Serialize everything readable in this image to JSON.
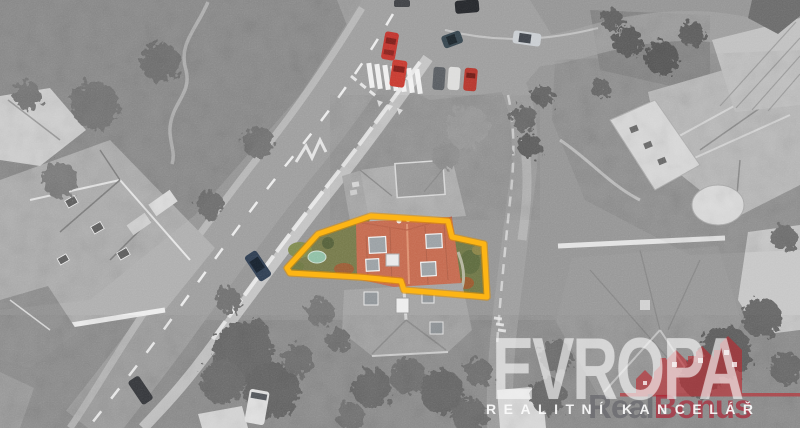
{
  "watermark": {
    "brand": "EVROPA",
    "tagline": "REALITNÍ KANCELÁŘ",
    "credit_gray": "Real",
    "credit_red": "Bonus"
  },
  "colors": {
    "parcel_outline": "#fdb515",
    "roof_highlight": "#c4694e",
    "logo_red": "rgba(192,38,45,0.60)",
    "garden_green": "#75794a",
    "pool_teal": "#8fbfa5",
    "car_red": "#c0342e"
  }
}
